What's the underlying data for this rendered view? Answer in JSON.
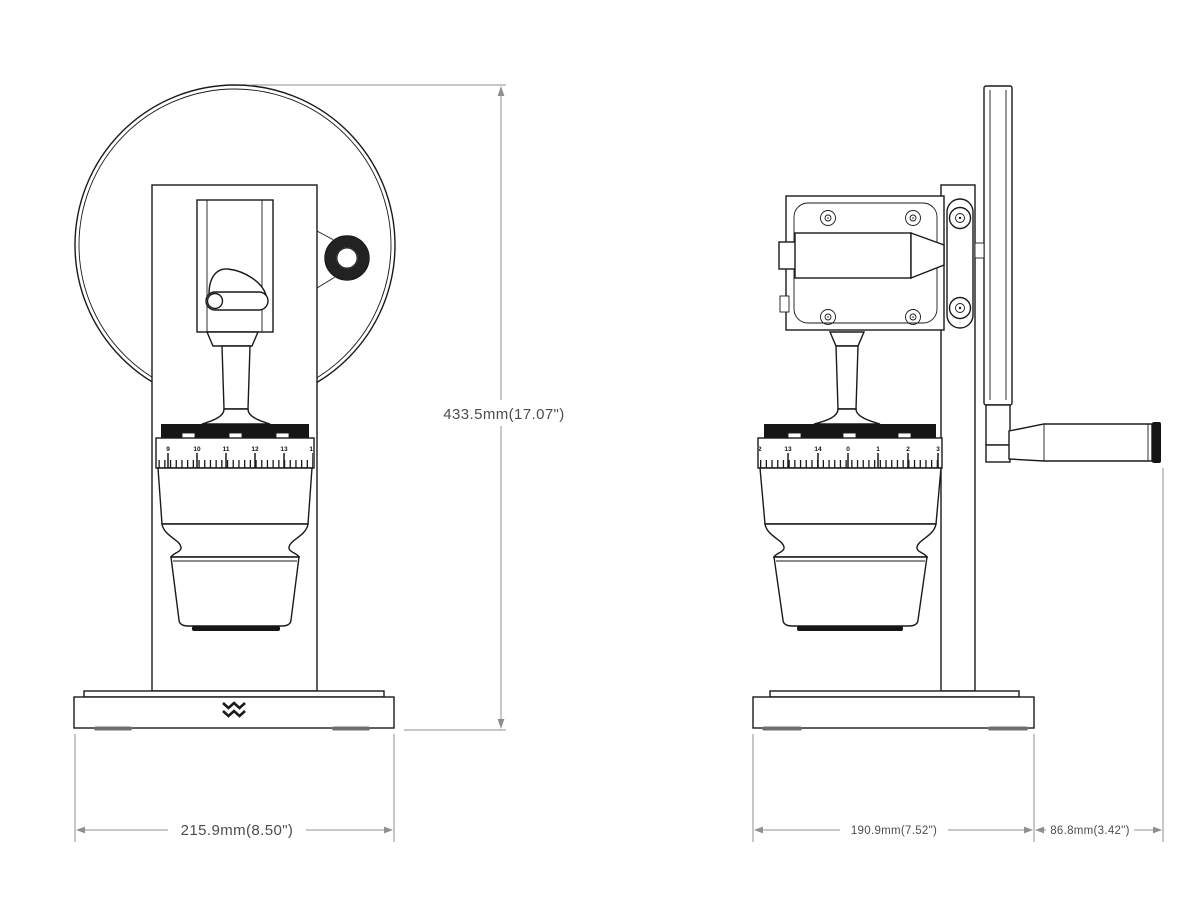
{
  "colors": {
    "background": "#ffffff",
    "line": "#1a1a1a",
    "dim_line": "#8f8f8f",
    "dim_text": "#4d4d4d",
    "dark_fill": "#161616",
    "foot": "#6f6f6f"
  },
  "views": {
    "front": {
      "dial_numbers": [
        "9",
        "10",
        "11",
        "12",
        "13",
        "14"
      ],
      "dimensions": {
        "height": "433.5mm(17.07\")",
        "base_width": "215.9mm(8.50\")"
      }
    },
    "side": {
      "dial_numbers": [
        "12",
        "13",
        "14",
        "0",
        "1",
        "2",
        "3"
      ],
      "dimensions": {
        "base_depth": "190.9mm(7.52\")",
        "handle_overhang": "86.8mm(3.42\")"
      }
    }
  },
  "logo": {
    "name": "double-zigzag-chevron-mark"
  }
}
